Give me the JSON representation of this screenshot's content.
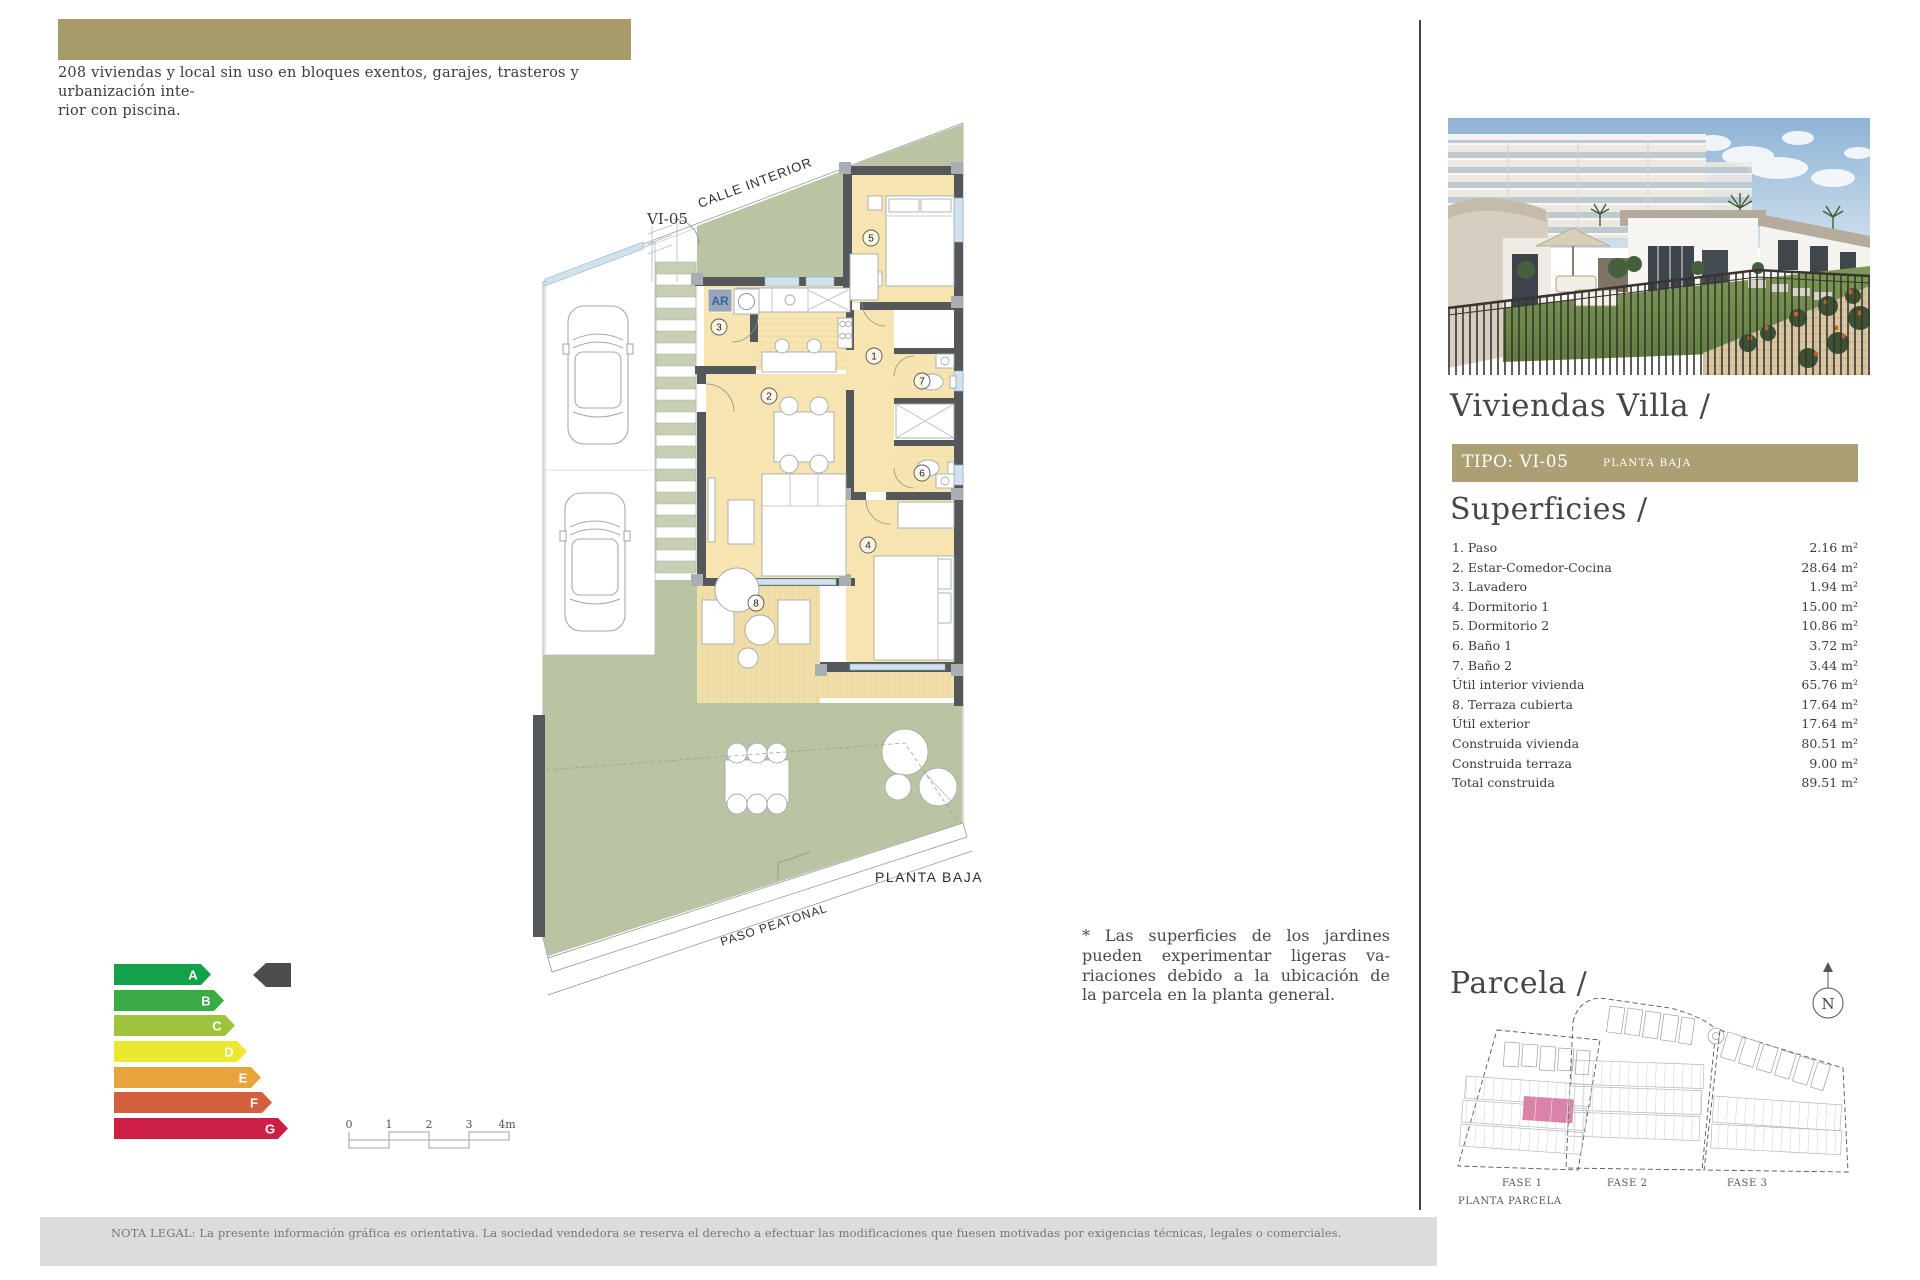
{
  "header": {
    "caption_lines": [
      "208 viviendas y local sin uso en bloques exentos, garajes, trasteros y urbanización inte-",
      "rior con piscina."
    ]
  },
  "plan": {
    "type_label": "VI-05",
    "street_label": "CALLE INTERIOR",
    "floor_label": "PLANTA BAJA",
    "path_label": "PASO PEATONAL",
    "laundry_label": "AR",
    "room_markers": [
      "1",
      "2",
      "3",
      "4",
      "5",
      "6",
      "7",
      "8"
    ]
  },
  "note": {
    "lines": [
      "* Las superficies de los jardines",
      "pueden experimentar ligeras va-",
      "riaciones debido a la ubicación de",
      "la parcela en la planta general."
    ]
  },
  "energy": {
    "labels": [
      "A",
      "B",
      "C",
      "D",
      "E",
      "F",
      "G"
    ]
  },
  "scale_bar": {
    "ticks": [
      "0",
      "1",
      "2",
      "3",
      "4m"
    ]
  },
  "legal": {
    "text": "NOTA LEGAL: La presente información gráfica es orientativa. La sociedad vendedora se reserva el derecho a efectuar las modificaciones que fuesen motivadas por exigencias técnicas, legales o comerciales."
  },
  "sidebar": {
    "title": "Viviendas Villa /",
    "tipo_label": "TIPO: VI-05",
    "tipo_sub": "PLANTA BAJA",
    "superficies_title": "Superficies /",
    "superficies": {
      "items": [
        {
          "label": "1. Paso",
          "value": "2.16 m²"
        },
        {
          "label": "2. Estar-Comedor-Cocina",
          "value": "28.64 m²"
        },
        {
          "label": "3. Lavadero",
          "value": "1.94 m²"
        },
        {
          "label": "4. Dormitorio 1",
          "value": "15.00 m²"
        },
        {
          "label": "5. Dormitorio 2",
          "value": "10.86 m²"
        },
        {
          "label": "6. Baño 1",
          "value": "3.72 m²"
        },
        {
          "label": "7. Baño 2",
          "value": "3.44 m²"
        },
        {
          "label": "Útil interior vivienda",
          "value": "65.76 m²"
        },
        {
          "label": "8. Terraza cubierta",
          "value": "17.64 m²"
        },
        {
          "label": "Útil exterior",
          "value": "17.64 m²"
        },
        {
          "label": "Construida vivienda",
          "value": "80.51 m²"
        },
        {
          "label": "Construida terraza",
          "value": "9.00 m²"
        },
        {
          "label": "Total construida",
          "value": "89.51 m²"
        }
      ]
    },
    "parcela_title": "Parcela /",
    "fases": [
      "FASE 1",
      "FASE 2",
      "FASE 3"
    ],
    "plan_label": "PLANTA PARCELA",
    "compass": "N"
  },
  "colors": {
    "olive": "#a79c69",
    "tipo_bar": "#ab9f74",
    "garden_green": "#b8c4a2",
    "room_yellow": "#f7e5b1",
    "wall_gray": "#54585b",
    "window_blue": "#cfe2ee",
    "parcel_pink": "#d983a8",
    "energy_a": "#14a14b",
    "energy_b": "#3aaa45",
    "energy_c": "#9ec43e",
    "energy_d": "#ece82f",
    "energy_e": "#e7a43c",
    "energy_f": "#d2603e",
    "energy_g": "#cd1f45"
  }
}
